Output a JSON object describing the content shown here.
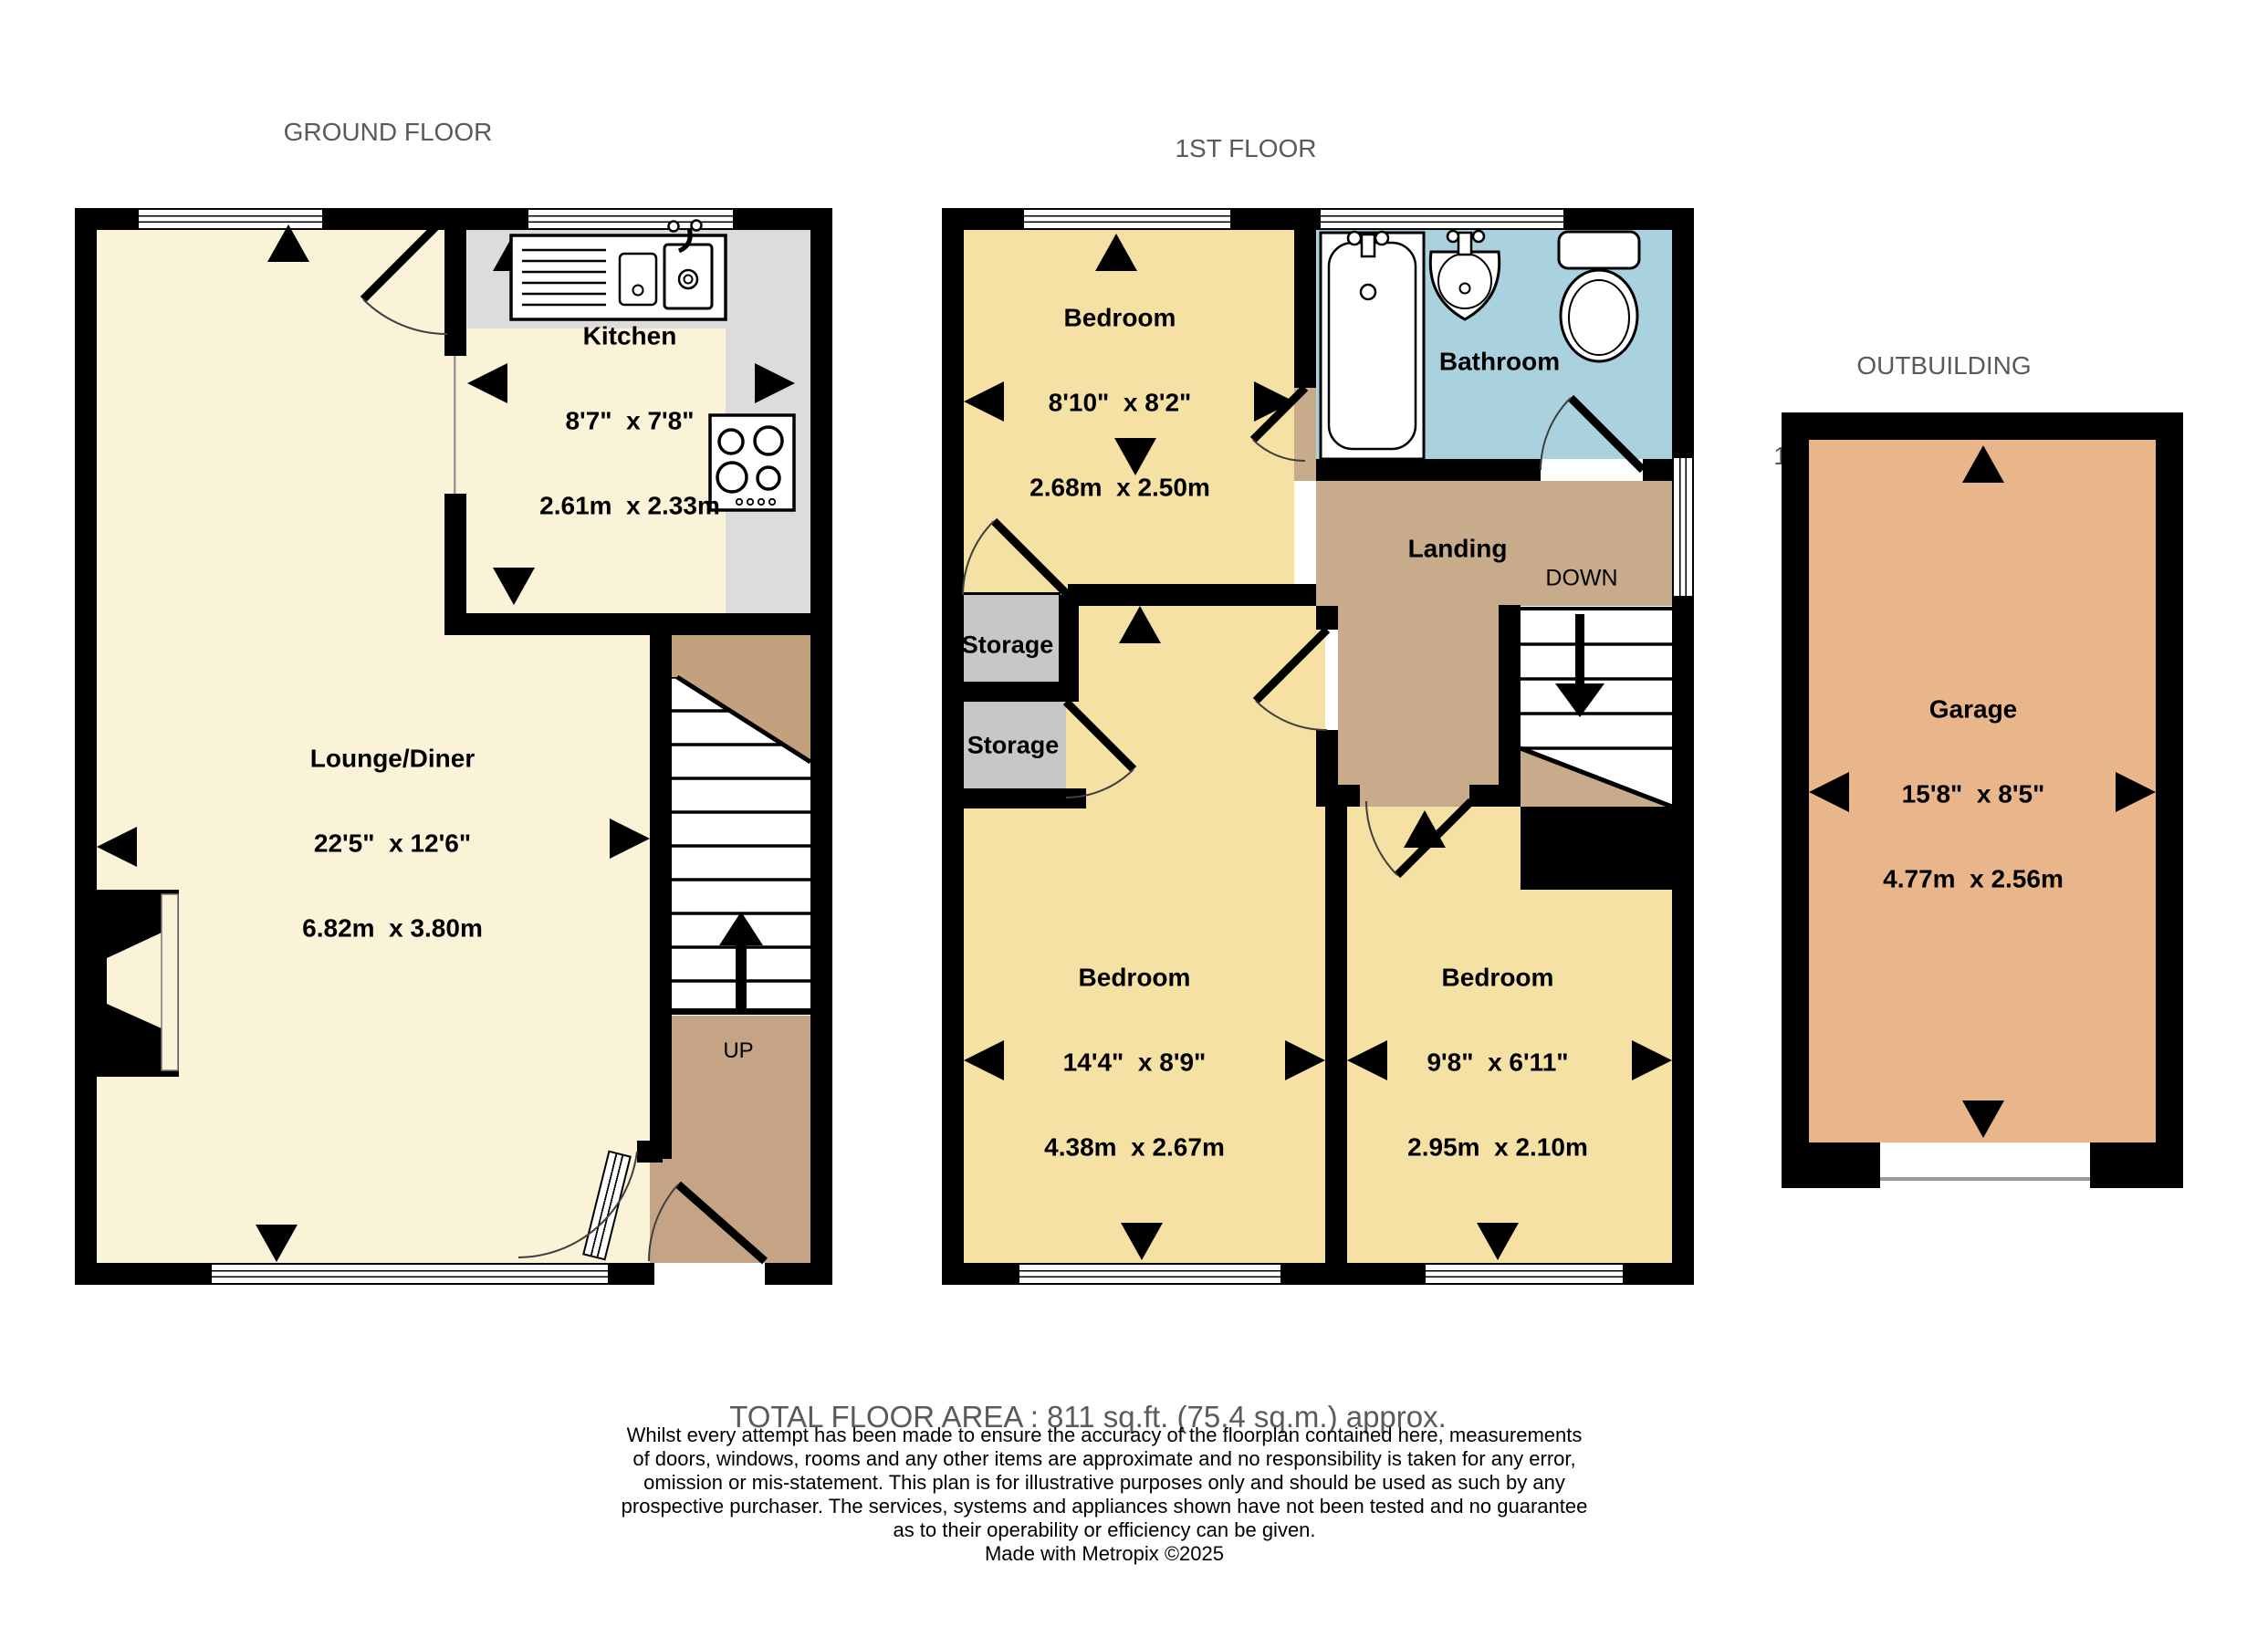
{
  "colors": {
    "wall": "#000000",
    "lounge": "#faf3d7",
    "bedroom": "#f5e1a4",
    "bathroom": "#a9d2de",
    "landing": "#c7ab8b",
    "vestibule": "#c4a484",
    "staircut": "#c3a17f",
    "storage": "#c7c7c7",
    "counter": "#dcdcdc",
    "garage": "#e9b68c",
    "title": "#595a5c"
  },
  "ground": {
    "title": "GROUND FLOOR",
    "area": "341 sq.ft. (31.6 sq.m.) approx.",
    "stairs_label": "UP",
    "rooms": {
      "lounge": {
        "name": "Lounge/Diner",
        "imperial": "22'5\"  x 12'6\"",
        "metric": "6.82m  x 3.80m"
      },
      "kitchen": {
        "name": "Kitchen",
        "imperial": "8'7\"  x 7'8\"",
        "metric": "2.61m  x 2.33m"
      }
    }
  },
  "first": {
    "title": "1ST FLOOR",
    "area": "339 sq.ft. (31.5 sq.m.) approx.",
    "stairs_label": "DOWN",
    "rooms": {
      "bedroom1": {
        "name": "Bedroom",
        "imperial": "8'10\"  x 8'2\"",
        "metric": "2.68m  x 2.50m"
      },
      "bathroom": {
        "name": "Bathroom"
      },
      "landing": {
        "name": "Landing"
      },
      "storage1": {
        "name": "Storage"
      },
      "storage2": {
        "name": "Storage"
      },
      "bedroom2": {
        "name": "Bedroom",
        "imperial": "14'4\"  x 8'9\"",
        "metric": "4.38m  x 2.67m"
      },
      "bedroom3": {
        "name": "Bedroom",
        "imperial": "9'8\"  x 6'11\"",
        "metric": "2.95m  x 2.10m"
      }
    }
  },
  "outbuilding": {
    "title": "OUTBUILDING",
    "area": "132 sq.ft. (12.2 sq.m.) approx.",
    "rooms": {
      "garage": {
        "name": "Garage",
        "imperial": "15'8\"  x 8'5\"",
        "metric": "4.77m  x 2.56m"
      }
    }
  },
  "footer": {
    "total": "TOTAL FLOOR AREA : 811 sq.ft. (75.4 sq.m.) approx.",
    "disclaimer_lines": [
      "Whilst every attempt has been made to ensure the accuracy of the floorplan contained here, measurements",
      "of doors, windows, rooms and any other items are approximate and no responsibility is taken for any error,",
      "omission or mis-statement. This plan is for illustrative purposes only and should be used as such by any",
      "prospective purchaser. The services, systems and appliances shown have not been tested and no guarantee",
      "as to their operability or efficiency can be given."
    ],
    "credit": "Made with Metropix ©2025"
  }
}
